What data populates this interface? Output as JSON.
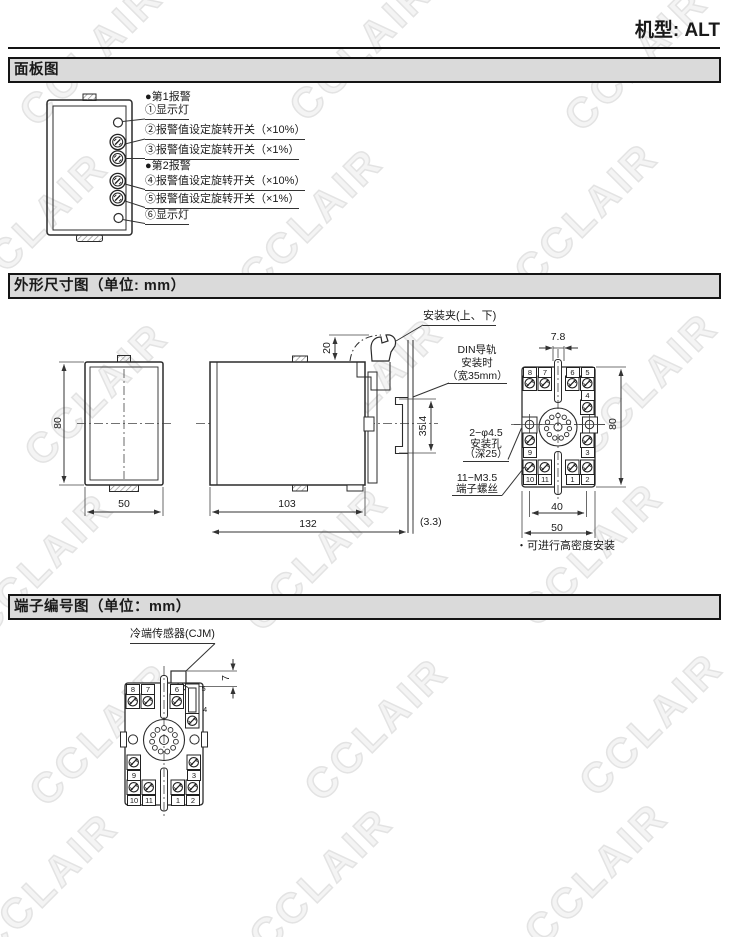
{
  "header": {
    "model_label": "机型: ALT"
  },
  "watermark": {
    "text": "CCLAIR"
  },
  "panel_section": {
    "title": "面板图",
    "alarm1_header": "●第1报警",
    "lamp1_label": "①显示灯",
    "sw2_label": "②报警值设定旋转开关（×10%）",
    "sw3_label": "③报警值设定旋转开关（×1%）",
    "alarm2_header": "●第2报警",
    "sw4_label": "④报警值设定旋转开关（×10%）",
    "sw5_label": "⑤报警值设定旋转开关（×1%）",
    "lamp6_label": "⑥显示灯"
  },
  "outline_section": {
    "title": "外形尺寸图（单位: mm）",
    "clip_label": "安装夹(上、下)",
    "din_label_line1": "DIN导轨",
    "din_label_line2": "安装时",
    "din_label_line3": "（宽35mm）",
    "hole_label_line1": "2−φ4.5",
    "hole_label_line2": "安装孔",
    "hole_label_line3": "（深25）",
    "screw_label_line1": "11−M3.5",
    "screw_label_line2": "端子螺丝",
    "density_note": "・可进行高密度安装",
    "front_height": "80",
    "front_width": "50",
    "clip_offset": "20",
    "body_depth": "103",
    "total_depth": "132",
    "rail_gap": "(3.3)",
    "rail_height": "35.4",
    "rear_pitch": "7.8",
    "rear_height": "80",
    "rear_hole_span": "40",
    "rear_width": "50"
  },
  "terminal_section": {
    "title": "端子编号图（单位：mm）",
    "cjm_label": "冷端传感器(CJM)",
    "cjm_height": "7"
  },
  "terminal_numbers": [
    "8",
    "7",
    "6",
    "5",
    "4",
    "9",
    "3",
    "10",
    "11",
    "1",
    "2"
  ]
}
